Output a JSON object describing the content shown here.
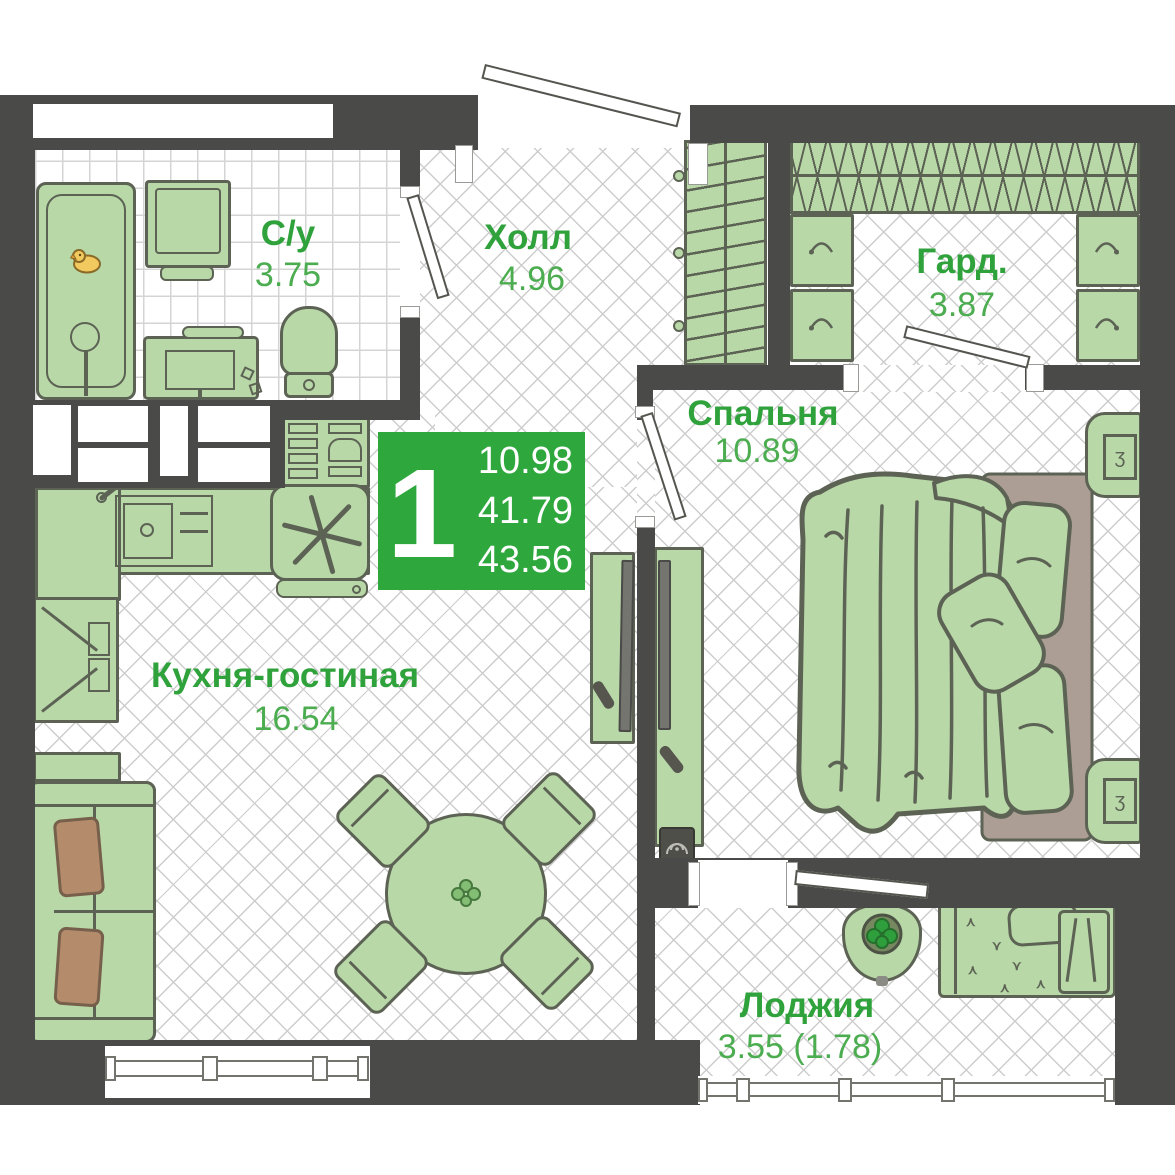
{
  "plan": {
    "badge": {
      "rooms": "1",
      "living_area": "10.98",
      "area_without_loggia": "41.79",
      "total_area": "43.56"
    },
    "rooms": [
      {
        "name": "С/у",
        "area": "3.75"
      },
      {
        "name": "Холл",
        "area": "4.96"
      },
      {
        "name": "Гард.",
        "area": "3.87"
      },
      {
        "name": "Спальня",
        "area": "10.89"
      },
      {
        "name": "Кухня-гостиная",
        "area": "16.54"
      },
      {
        "name": "Лоджия",
        "area": "3.55 (1.78)"
      }
    ],
    "colors": {
      "accent_green": "#2ea83c",
      "label_green": "#2fa23c",
      "wall": "#4a4a48",
      "furniture_fill": "#b9d8a8",
      "furniture_outline": "#5c6354",
      "pillow_tan": "#b48c6c",
      "headboard_tan": "#ad9e95"
    },
    "furniture": [
      "bathtub",
      "washing-machine",
      "vanity-sink",
      "toilet",
      "coat-closet",
      "clothes-rail",
      "shelf-hooks",
      "kitchen-counter",
      "kitchen-sink",
      "stove",
      "tall-cabinet",
      "sofa",
      "dining-table",
      "chairs",
      "tv",
      "desk-monitor",
      "speaker",
      "double-bed",
      "nightstands",
      "plant-table",
      "daybed"
    ]
  }
}
